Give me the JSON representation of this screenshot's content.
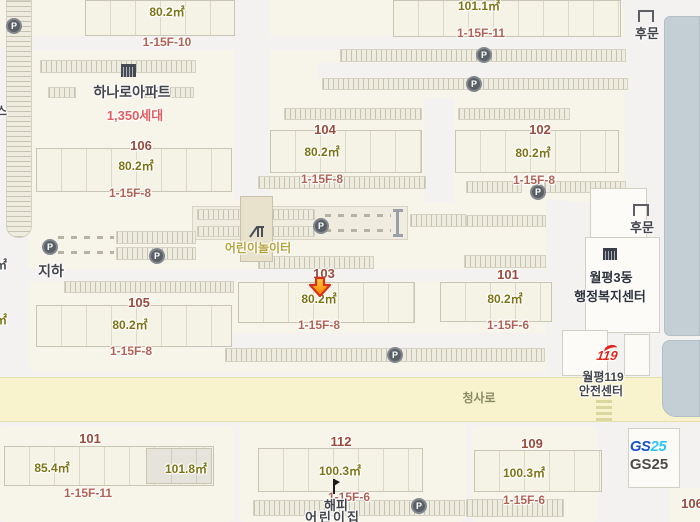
{
  "complex": {
    "name": "하나로아파트",
    "households": "1,350세대",
    "underground_label": "지하",
    "playground_label": "어린이놀이터",
    "back_gate_top": "후문",
    "back_gate_mid": "후문"
  },
  "parking": {
    "symbol": "P"
  },
  "buildings": {
    "top_left": {
      "area": "80.2㎡",
      "floors": "1-15F-10"
    },
    "top_right": {
      "area": "101.1㎡",
      "floors": "1-15F-11"
    },
    "b106": {
      "no": "106",
      "area": "80.2㎡",
      "floors": "1-15F-8"
    },
    "b104": {
      "no": "104",
      "area": "80.2㎡",
      "floors": "1-15F-8"
    },
    "b102": {
      "no": "102",
      "area": "80.2㎡",
      "floors": "1-15F-8"
    },
    "b105": {
      "no": "105",
      "area": "80.2㎡",
      "floors": "1-15F-8"
    },
    "b103": {
      "no": "103",
      "area": "80.2㎡",
      "floors": "1-15F-8",
      "selected": true
    },
    "b101_mid": {
      "no": "101",
      "area": "80.2㎡",
      "floors": "1-15F-6"
    },
    "b101_south": {
      "no": "101",
      "area_left": "85.4㎡",
      "area_right": "101.8㎡",
      "floors": "1-15F-11"
    },
    "b112": {
      "no": "112",
      "area": "100.3㎡",
      "floors": "1-15F-6"
    },
    "b109": {
      "no": "109",
      "area": "100.3㎡",
      "floors": "1-15F-6"
    },
    "b106_corner": {
      "no": "106"
    }
  },
  "pois": {
    "community_center": {
      "line1": "월평3동",
      "line2": "행정복지센터"
    },
    "fire_station": {
      "logo": "119",
      "line1": "월평119",
      "line2": "안전센터"
    },
    "gs25": {
      "logo_gs": "GS",
      "logo_25": "25",
      "label": "GS25"
    },
    "daycare": {
      "line1": "해피",
      "line2": "어린이집"
    }
  },
  "roads": {
    "main": "청사로"
  },
  "edge_partials": {
    "p1": "스",
    "p2": "㎡",
    "p3": "㎡"
  },
  "marker": {
    "type": "arrow-down",
    "target": "103",
    "fill_top": "#ffd040",
    "fill_bottom": "#ff7b00",
    "stroke": "#d6311a"
  },
  "colors": {
    "road_fill": "#f8f3cc",
    "complex_fill": "#f7f4ea",
    "building_fill": "#f5f2e6",
    "blue_building": "#c4cfd5",
    "gs_blue": "#1752c5",
    "gs_cyan": "#2ec4f3",
    "label_brick": "#9a4b3c",
    "label_olive": "#7c7414",
    "label_rose": "#b06355"
  }
}
